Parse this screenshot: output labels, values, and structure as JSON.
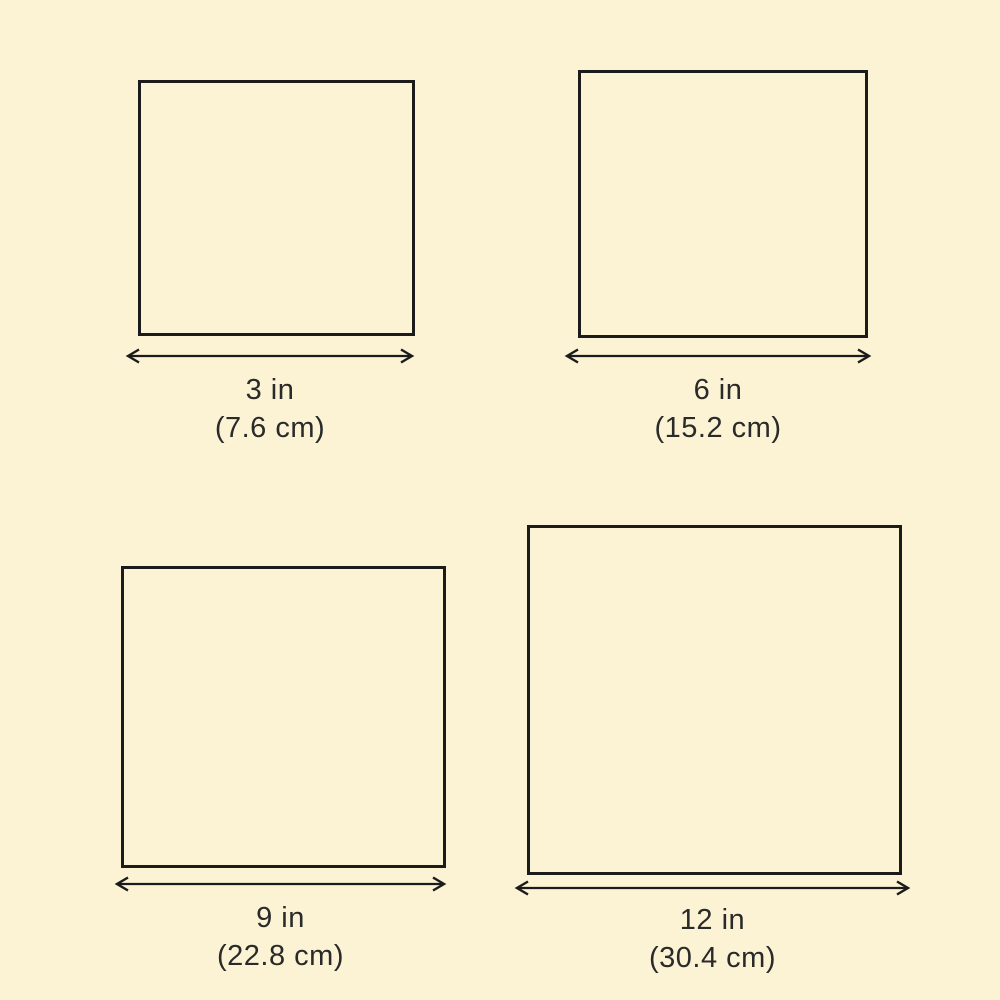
{
  "theme": {
    "background": "#FCF3D4",
    "line_color": "#1B1B1B",
    "text_color": "#2A2A2A"
  },
  "figures": [
    {
      "name": "square-3in",
      "inches_label": "3 in",
      "cm_label": "(7.6 cm)"
    },
    {
      "name": "square-6in",
      "inches_label": "6 in",
      "cm_label": "(15.2 cm)"
    },
    {
      "name": "square-9in",
      "inches_label": "9 in",
      "cm_label": "(22.8 cm)"
    },
    {
      "name": "square-12in",
      "inches_label": "12 in",
      "cm_label": "(30.4 cm)"
    }
  ]
}
